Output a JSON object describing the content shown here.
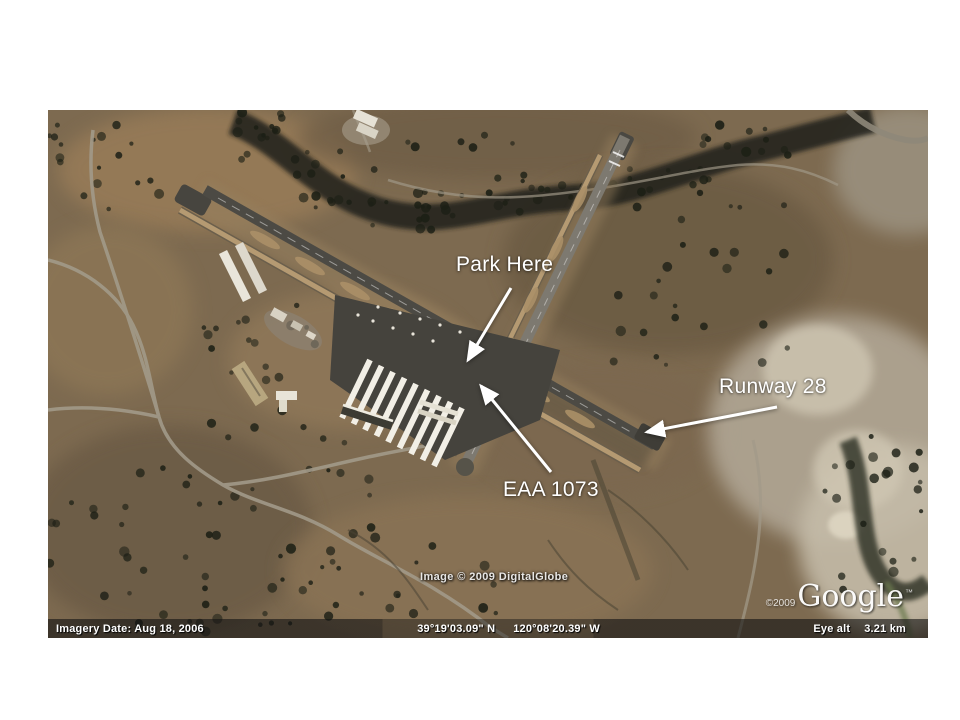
{
  "annotations": {
    "park_here": "Park Here",
    "eaa": "EAA 1073",
    "runway_28": "Runway 28"
  },
  "overlay": {
    "digitalglobe": "Image © 2009 DigitalGlobe",
    "google_copyright": "©2009",
    "google_brand": "Google",
    "google_tm": "™"
  },
  "status_bar": {
    "imagery_date": "Imagery Date: Aug 18, 2006",
    "latitude": "39°19'03.09\" N",
    "longitude": "120°08'20.39\" W",
    "eye_alt_label": "Eye alt",
    "eye_alt_value": "3.21 km"
  },
  "colors": {
    "slide_background": "#ffffff",
    "terrain_base": "#7d6a50",
    "runway_main": "#4c4a44",
    "runway_cross": "#7d7970",
    "taxiway": "#b59a72",
    "annotation_text": "#ffffff"
  }
}
